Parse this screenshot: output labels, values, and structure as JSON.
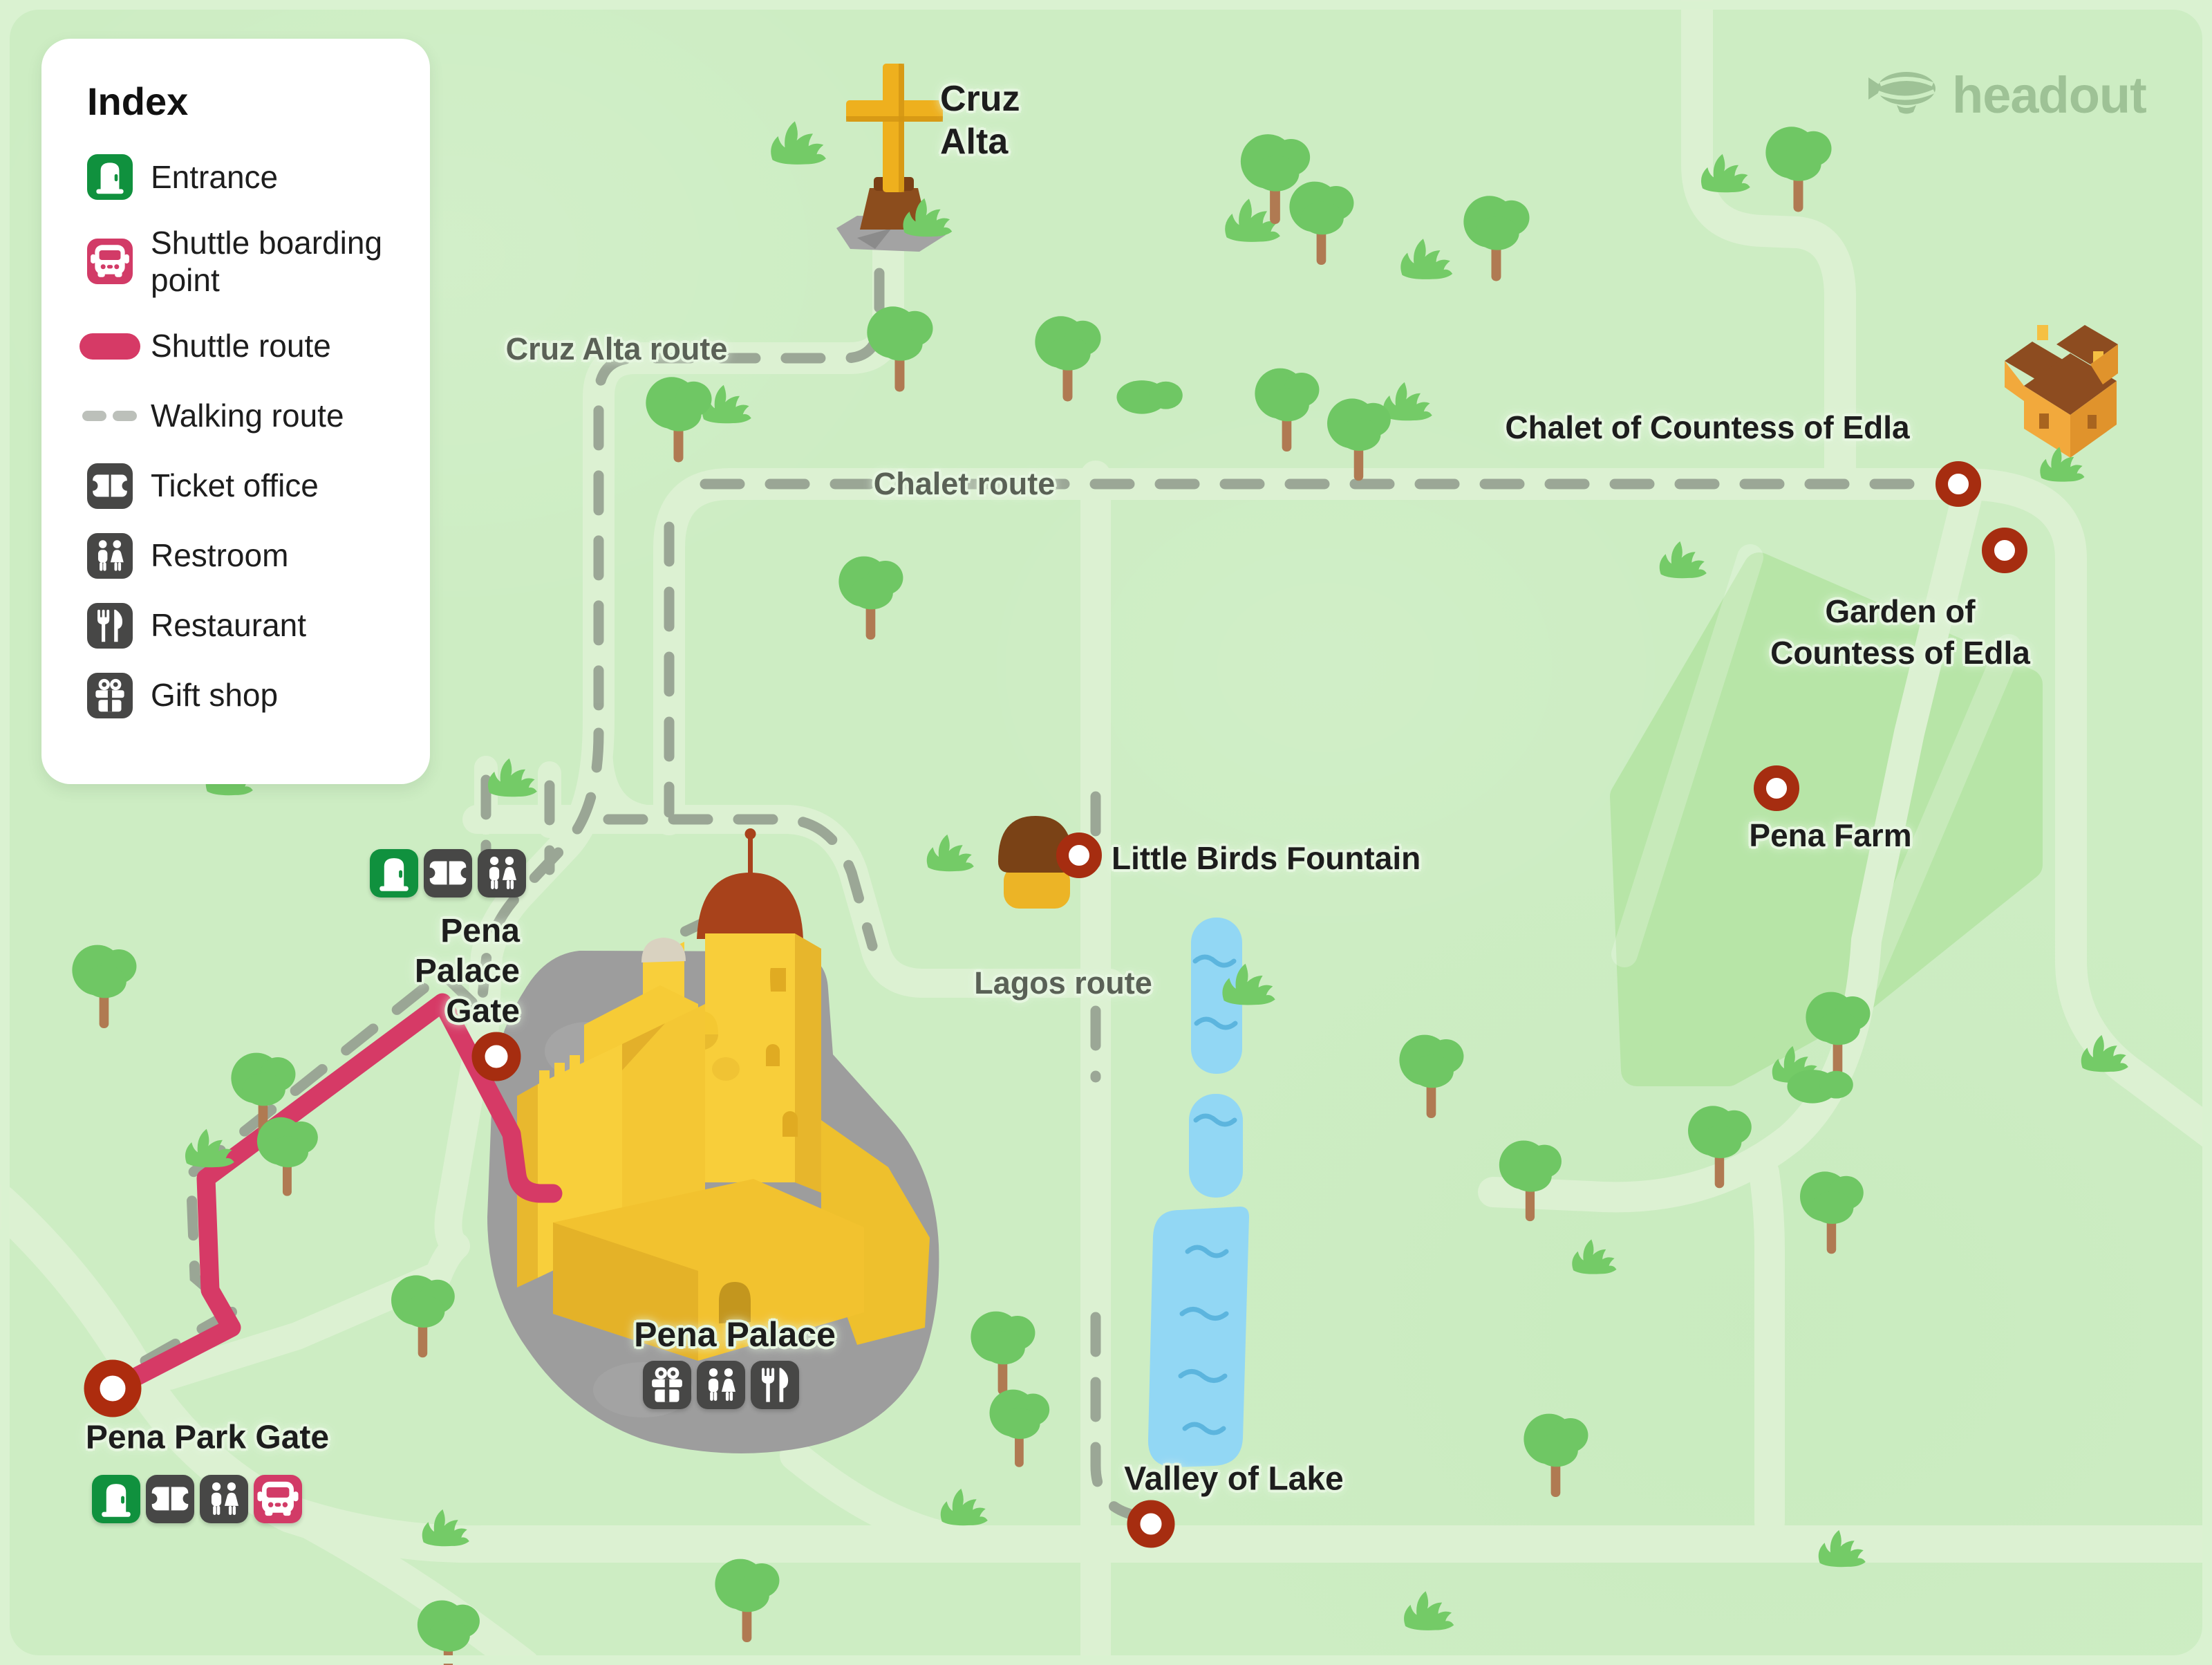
{
  "brand": {
    "name": "headout"
  },
  "legend": {
    "title": "Index",
    "items": [
      {
        "id": "entrance",
        "label": "Entrance",
        "icon": "door-icon",
        "color": "#10913e"
      },
      {
        "id": "shuttle-boarding-point",
        "label": "Shuttle boarding point",
        "icon": "bus-icon",
        "color": "#d23b67"
      },
      {
        "id": "shuttle-route",
        "label": "Shuttle route",
        "icon": "route-pill",
        "color": "#d63a66"
      },
      {
        "id": "walking-route",
        "label": "Walking route",
        "icon": "route-dashes",
        "color": "#bcc0ba"
      },
      {
        "id": "ticket-office",
        "label": "Ticket office",
        "icon": "ticket-icon",
        "color": "#474746"
      },
      {
        "id": "restroom",
        "label": "Restroom",
        "icon": "restroom-icon",
        "color": "#474746"
      },
      {
        "id": "restaurant",
        "label": "Restaurant",
        "icon": "restaurant-icon",
        "color": "#474746"
      },
      {
        "id": "gift-shop",
        "label": "Gift shop",
        "icon": "gift-icon",
        "color": "#474746"
      }
    ]
  },
  "map": {
    "labels": {
      "cruz_alta": {
        "text": "Cruz Alta",
        "lines": [
          "Cruz",
          "Alta"
        ]
      },
      "cruz_alta_route": {
        "text": "Cruz Alta route"
      },
      "chalet_route": {
        "text": "Chalet route"
      },
      "chalet": {
        "text": "Chalet of Countess of Edla"
      },
      "garden": {
        "text": "Garden of Countess of Edla",
        "lines": [
          "Garden of",
          "Countess of Edla"
        ]
      },
      "pena_farm": {
        "text": "Pena Farm"
      },
      "little_birds_fountain": {
        "text": "Little Birds Fountain"
      },
      "lagos_route": {
        "text": "Lagos route"
      },
      "pena_palace": {
        "text": "Pena Palace"
      },
      "pena_palace_gate": {
        "text": "Pena Palace Gate",
        "lines": [
          "Pena",
          "Palace",
          "Gate"
        ]
      },
      "pena_park_gate": {
        "text": "Pena Park Gate"
      },
      "valley_of_lake": {
        "text": "Valley of Lake"
      }
    },
    "amenities": {
      "pena_palace_gate": [
        "entrance",
        "ticket-office",
        "restroom"
      ],
      "pena_palace": [
        "gift-shop",
        "restroom",
        "restaurant"
      ],
      "pena_park_gate": [
        "entrance",
        "ticket-office",
        "restroom",
        "shuttle-boarding-point"
      ]
    },
    "colors": {
      "background": "#cdedc3",
      "road": "#dcf1d2",
      "garden_area": "#b7e5a7",
      "shuttle_route": "#d63a66",
      "walking_route": "#97a292",
      "marker_ring": "#a62d10",
      "lake": "#92d7f4",
      "palace": "#f8ce3a",
      "rock": "#9d9d9d"
    }
  }
}
